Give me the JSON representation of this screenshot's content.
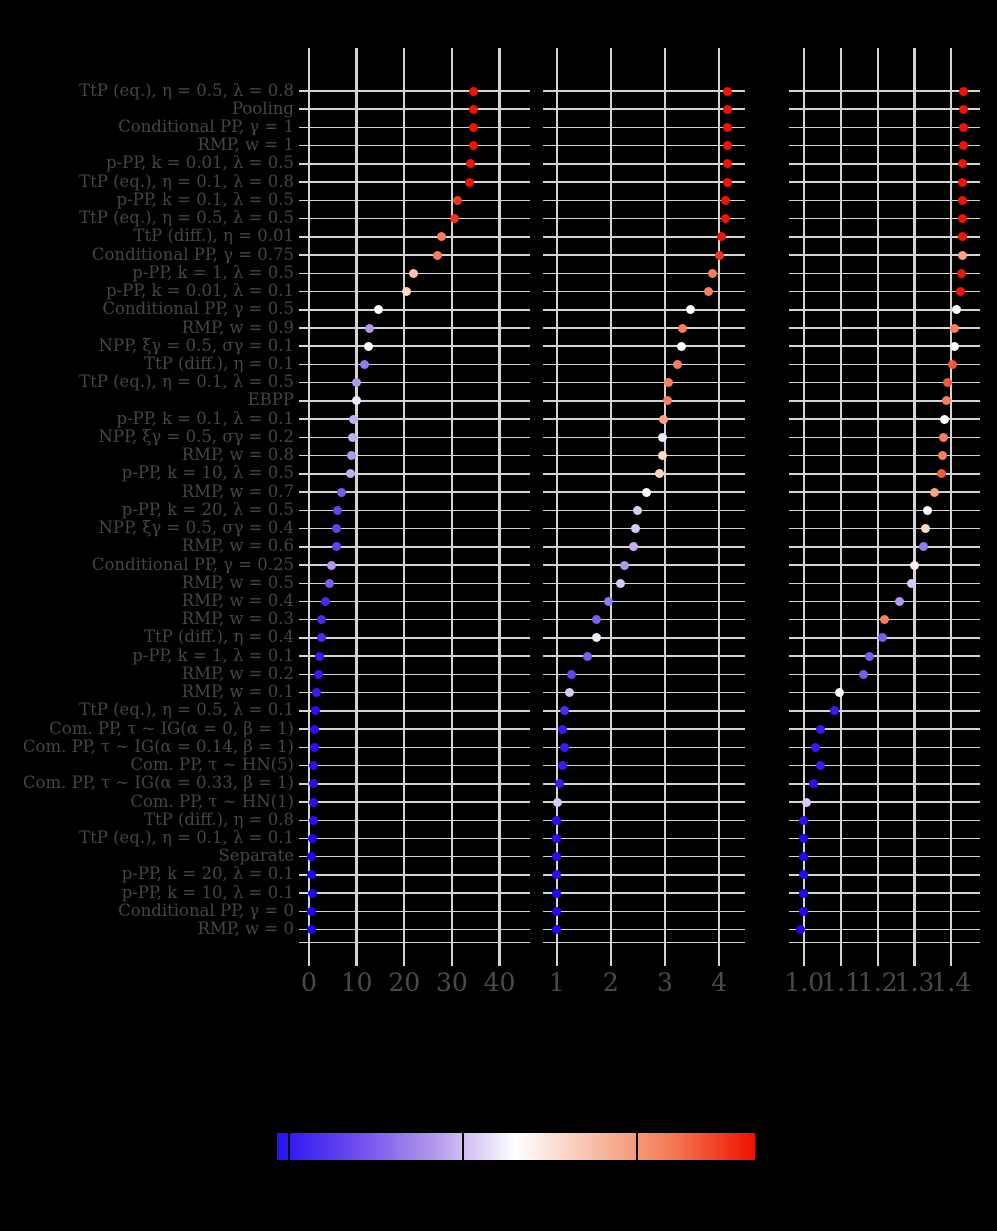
{
  "figure": {
    "background": "#000000",
    "grid_color": "#d4d4d4",
    "text_color": "#4a4a4c"
  },
  "chart_data": {
    "type": "scatter",
    "title": "",
    "categories": [
      "TtP (eq.), η = 0.5, λ = 0.8",
      "Pooling",
      "Conditional PP, γ = 1",
      "RMP, w = 1",
      "p-PP, k = 0.01, λ = 0.5",
      "TtP (eq.), η = 0.1, λ = 0.8",
      "p-PP, k = 0.1, λ = 0.5",
      "TtP (eq.), η = 0.5, λ = 0.5",
      "TtP (diff.), η = 0.01",
      "Conditional PP, γ = 0.75",
      "p-PP, k = 1, λ = 0.5",
      "p-PP, k = 0.01, λ = 0.1",
      "Conditional PP, γ = 0.5",
      "RMP, w = 0.9",
      "NPP, ξγ = 0.5, σγ = 0.1",
      "TtP (diff.), η = 0.1",
      "TtP (eq.), η = 0.1, λ = 0.5",
      "EBPP",
      "p-PP, k = 0.1, λ = 0.1",
      "NPP, ξγ = 0.5, σγ = 0.2",
      "RMP, w = 0.8",
      "p-PP, k = 10, λ = 0.5",
      "RMP, w = 0.7",
      "p-PP, k = 20, λ = 0.5",
      "NPP, ξγ = 0.5, σγ = 0.4",
      "RMP, w = 0.6",
      "Conditional PP, γ = 0.25",
      "RMP, w = 0.5",
      "RMP, w = 0.4",
      "RMP, w = 0.3",
      "TtP (diff.), η = 0.4",
      "p-PP, k = 1, λ = 0.1",
      "RMP, w = 0.2",
      "RMP, w = 0.1",
      "TtP (eq.), η = 0.5, λ = 0.1",
      "Com. PP, τ ~ IG(α = 0, β = 1)",
      "Com. PP, τ ~ IG(α = 0.14, β = 1)",
      "Com. PP, τ ~ HN(5)",
      "Com. PP, τ ~ IG(α = 0.33, β = 1)",
      "Com. PP, τ ~ HN(1)",
      "TtP (diff.), η = 0.8",
      "TtP (eq.), η = 0.1, λ = 0.1",
      "Separate",
      "p-PP, k = 20, λ = 0.1",
      "p-PP, k = 10, λ = 0.1",
      "Conditional PP, γ = 0",
      "RMP, w = 0"
    ],
    "panels": [
      {
        "xlabel": "",
        "ticks": [
          0,
          10,
          20,
          30,
          40
        ],
        "tick_labels": [
          "0",
          "10",
          "20",
          "30",
          "40"
        ],
        "xlim": [
          -2.1,
          46.4
        ],
        "values": [
          34.5,
          34.5,
          34.5,
          34.5,
          34.0,
          33.6,
          31.2,
          30.5,
          27.8,
          27.0,
          21.9,
          20.4,
          14.5,
          12.8,
          12.5,
          11.6,
          9.9,
          9.9,
          9.3,
          9.1,
          9.0,
          8.7,
          6.9,
          5.9,
          5.8,
          5.7,
          4.8,
          4.4,
          3.5,
          2.7,
          2.7,
          2.2,
          2.0,
          1.5,
          1.3,
          1.1,
          1.05,
          1.0,
          1.0,
          0.9,
          0.85,
          0.7,
          0.6,
          0.6,
          0.65,
          0.6,
          0.6
        ],
        "dot_colors": [
          "#f01306",
          "#f01306",
          "#f01306",
          "#f01306",
          "#f01306",
          "#f01306",
          "#f23520",
          "#f23520",
          "#f57f5d",
          "#f57f5d",
          "#fac3ab",
          "#fbd7c5",
          "#ffffff",
          "#b298ec",
          "#ffffff",
          "#9578ee",
          "#b298ec",
          "#f0e8fb",
          "#c4adf0",
          "#c4adf0",
          "#b298ec",
          "#c4adf0",
          "#7e5cee",
          "#6443ef",
          "#6443ef",
          "#6443ef",
          "#b298ec",
          "#7e5cee",
          "#4c2bf1",
          "#4c2bf1",
          "#4c2bf1",
          "#3a1af3",
          "#3a1af3",
          "#3a1af3",
          "#2b0ef5",
          "#2b0ef5",
          "#2b0ef5",
          "#2b0ef5",
          "#2b0ef5",
          "#2b0ef5",
          "#2b0ef5",
          "#2007f7",
          "#2007f7",
          "#2007f7",
          "#2007f7",
          "#2007f7",
          "#2007f7"
        ]
      },
      {
        "xlabel": "",
        "ticks": [
          1,
          2,
          3,
          4
        ],
        "tick_labels": [
          "1",
          "2",
          "3",
          "4"
        ],
        "xlim": [
          0.75,
          4.5
        ],
        "values": [
          4.15,
          4.15,
          4.15,
          4.15,
          4.15,
          4.15,
          4.11,
          4.11,
          4.05,
          4.01,
          3.87,
          3.81,
          3.47,
          3.33,
          3.31,
          3.23,
          3.06,
          3.04,
          2.98,
          2.96,
          2.95,
          2.9,
          2.66,
          2.49,
          2.46,
          2.41,
          2.25,
          2.17,
          1.96,
          1.73,
          1.73,
          1.57,
          1.27,
          1.23,
          1.15,
          1.1,
          1.14,
          1.1,
          1.05,
          1.01,
          1.0,
          1.0,
          1.0,
          1.0,
          1.0,
          0.99,
          0.99
        ],
        "dot_colors": [
          "#f01306",
          "#f01306",
          "#f01306",
          "#f01306",
          "#f01306",
          "#f01306",
          "#f01306",
          "#f01306",
          "#f01306",
          "#f23520",
          "#f57f5d",
          "#f57f5d",
          "#ffffff",
          "#f57f5d",
          "#ffffff",
          "#f57f5d",
          "#f57f5d",
          "#f57f5d",
          "#f8a485",
          "#f0e8fb",
          "#fbd7c5",
          "#fbd7c5",
          "#ffffff",
          "#d9c8f6",
          "#d9c8f6",
          "#c4adf0",
          "#b298ec",
          "#d9c8f6",
          "#9578ee",
          "#7e5cee",
          "#f0e8fb",
          "#7e5cee",
          "#6443ef",
          "#d9c8f6",
          "#4c2bf1",
          "#3a1af3",
          "#3a1af3",
          "#3a1af3",
          "#3a1af3",
          "#d9c8f6",
          "#2b0ef5",
          "#2b0ef5",
          "#2b0ef5",
          "#2b0ef5",
          "#2007f7",
          "#2007f7",
          "#2007f7"
        ]
      },
      {
        "xlabel": "",
        "ticks": [
          1.0,
          1.1,
          1.2,
          1.3,
          1.4
        ],
        "tick_labels": [
          "1.0",
          "1.1",
          "1.2",
          "1.3",
          "1.4"
        ],
        "xlim": [
          0.958,
          1.478
        ],
        "values": [
          1.433,
          1.433,
          1.433,
          1.433,
          1.43,
          1.43,
          1.43,
          1.43,
          1.43,
          1.43,
          1.427,
          1.425,
          1.414,
          1.41,
          1.408,
          1.403,
          1.39,
          1.387,
          1.381,
          1.379,
          1.376,
          1.373,
          1.353,
          1.334,
          1.33,
          1.325,
          1.301,
          1.293,
          1.258,
          1.219,
          1.214,
          1.178,
          1.161,
          1.096,
          1.082,
          1.043,
          1.03,
          1.043,
          1.025,
          1.007,
          0.997,
          0.997,
          0.997,
          0.997,
          0.997,
          0.997,
          0.99
        ],
        "dot_colors": [
          "#f01306",
          "#f01306",
          "#f01306",
          "#f01306",
          "#f01306",
          "#f01306",
          "#f01306",
          "#f01306",
          "#f01306",
          "#f8a485",
          "#f01306",
          "#f01306",
          "#ffffff",
          "#f57f5d",
          "#ffffff",
          "#f4573a",
          "#f4573a",
          "#f57f5d",
          "#ffffff",
          "#f57f5d",
          "#f57f5d",
          "#f4573a",
          "#f8a485",
          "#ffffff",
          "#fbd7c5",
          "#9578ee",
          "#fdefe9",
          "#d9c8f6",
          "#b298ec",
          "#f57f5d",
          "#7e5cee",
          "#7e5cee",
          "#7e5cee",
          "#ffffff",
          "#3a1af3",
          "#3a1af3",
          "#3a1af3",
          "#3a1af3",
          "#2b0ef5",
          "#d9c8f6",
          "#2b0ef5",
          "#2007f7",
          "#2007f7",
          "#2007f7",
          "#2007f7",
          "#2007f7",
          "#2007f7"
        ]
      }
    ],
    "colorbar": {
      "orientation": "horizontal",
      "gradient": [
        "#2512f4",
        "#6e4cee",
        "#b49aec",
        "#ffffff",
        "#f8bca4",
        "#f4764f",
        "#f01000"
      ],
      "tick_positions_frac": [
        0.025,
        0.389,
        0.753
      ],
      "labels_visible": false
    },
    "grid": true,
    "legend_position": "none"
  }
}
